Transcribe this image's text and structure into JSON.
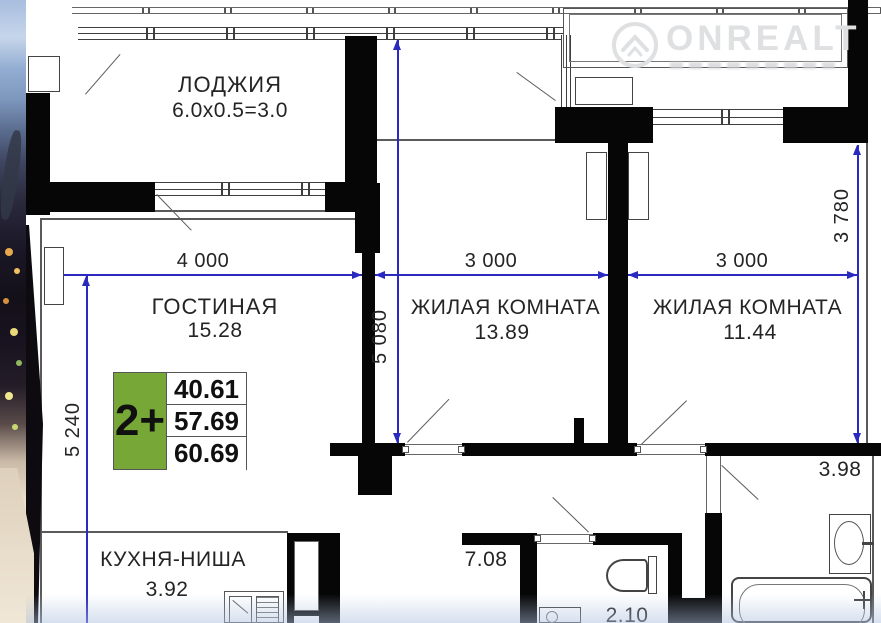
{
  "watermark": {
    "brand": "ONREALT"
  },
  "plan": {
    "rooms": {
      "loggia": {
        "name": "ЛОДЖИЯ",
        "dims": "6.0x0.5=3.0"
      },
      "living": {
        "name": "ГОСТИНАЯ",
        "area": "15.28"
      },
      "bedroom1": {
        "name": "ЖИЛАЯ КОМНАТА",
        "area": "13.89"
      },
      "bedroom2": {
        "name": "ЖИЛАЯ КОМНАТА",
        "area": "11.44"
      },
      "kitchen": {
        "name": "КУХНЯ-НИША",
        "area": "3.92"
      },
      "hallway": {
        "area": "7.08"
      },
      "toilet": {
        "area": "2.10"
      },
      "bathroom": {
        "area": "3.98"
      }
    },
    "dimensions": {
      "top": [
        "4 000",
        "3 000",
        "3 000"
      ],
      "left": "5 240",
      "middle": "5 080",
      "right": "3 780"
    }
  },
  "badge": {
    "type": "2+",
    "areas": [
      "40.61",
      "57.69",
      "60.69"
    ]
  },
  "colors": {
    "badge_green": "#77a837",
    "dimension_blue": "#2a2ac0",
    "wall_black": "#060606",
    "watermark_gray": "#dfe0e2"
  }
}
